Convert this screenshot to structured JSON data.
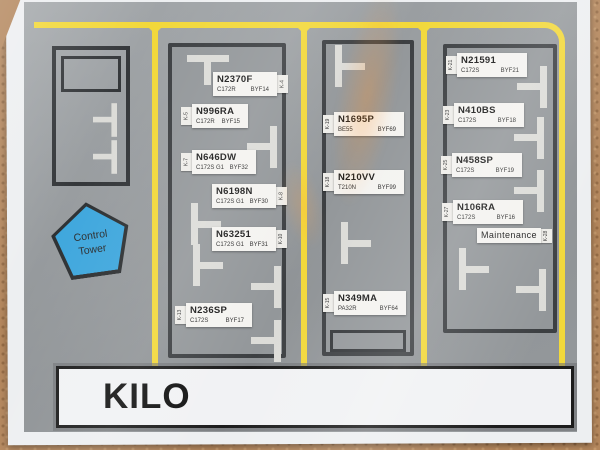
{
  "banner": {
    "title": "KILO"
  },
  "control_tower": {
    "label": "Control Tower"
  },
  "colors": {
    "taxiway_yellow": "#f2d83a",
    "tower_blue": "#3fa7dd",
    "label_white": "#f4f3f0",
    "cork_tan": "#b3865c"
  },
  "spots": [
    {
      "id": "K-4",
      "reg": "N2370F",
      "model": "C172R",
      "code": "BYF14",
      "x": 213,
      "y": 72,
      "w": 64,
      "tab": "right"
    },
    {
      "id": "K-5",
      "reg": "N996RA",
      "model": "C172R",
      "code": "BYF15",
      "x": 192,
      "y": 104,
      "w": 56,
      "tab": "left"
    },
    {
      "id": "K-7",
      "reg": "N646DW",
      "model": "C172S G1",
      "code": "BYF32",
      "x": 192,
      "y": 150,
      "w": 64,
      "tab": "left"
    },
    {
      "id": "K-8",
      "reg": "N6198N",
      "model": "C172S G1",
      "code": "BYF30",
      "x": 212,
      "y": 184,
      "w": 64,
      "tab": "right"
    },
    {
      "id": "K-10",
      "reg": "N63251",
      "model": "C172S G1",
      "code": "BYF31",
      "x": 212,
      "y": 227,
      "w": 64,
      "tab": "right"
    },
    {
      "id": "K-13",
      "reg": "N236SP",
      "model": "C172S",
      "code": "BYF17",
      "x": 186,
      "y": 303,
      "w": 66,
      "tab": "left"
    },
    {
      "id": "K-19",
      "reg": "N1695P",
      "model": "BE55",
      "code": "BYF69",
      "x": 334,
      "y": 112,
      "w": 70,
      "tab": "left"
    },
    {
      "id": "K-18",
      "reg": "N210VV",
      "model": "T210N",
      "code": "BYF99",
      "x": 334,
      "y": 170,
      "w": 70,
      "tab": "left"
    },
    {
      "id": "K-15",
      "reg": "N349MA",
      "model": "PA32R",
      "code": "BYF64",
      "x": 334,
      "y": 291,
      "w": 72,
      "tab": "left"
    },
    {
      "id": "K-21",
      "reg": "N21591",
      "model": "C172S",
      "code": "BYF21",
      "x": 457,
      "y": 53,
      "w": 70,
      "tab": "left"
    },
    {
      "id": "K-23",
      "reg": "N410BS",
      "model": "C172S",
      "code": "BYF18",
      "x": 454,
      "y": 103,
      "w": 70,
      "tab": "left"
    },
    {
      "id": "K-25",
      "reg": "N458SP",
      "model": "C172S",
      "code": "BYF19",
      "x": 452,
      "y": 153,
      "w": 70,
      "tab": "left"
    },
    {
      "id": "K-27",
      "reg": "N106RA",
      "model": "C172S",
      "code": "BYF16",
      "x": 453,
      "y": 200,
      "w": 70,
      "tab": "left"
    },
    {
      "id": "K-28",
      "reg": "Maintenance",
      "model": "",
      "code": "",
      "x": 477,
      "y": 228,
      "w": 64,
      "tab": "right",
      "single": true
    }
  ],
  "tie_downs": [
    {
      "x": 208,
      "y": 70,
      "r": 0
    },
    {
      "x": 262,
      "y": 147,
      "r": 90
    },
    {
      "x": 206,
      "y": 224,
      "r": -90
    },
    {
      "x": 208,
      "y": 265,
      "r": -90
    },
    {
      "x": 266,
      "y": 287,
      "r": 90
    },
    {
      "x": 266,
      "y": 341,
      "r": 90
    },
    {
      "x": 350,
      "y": 66,
      "r": -90
    },
    {
      "x": 356,
      "y": 243,
      "r": -90
    },
    {
      "x": 532,
      "y": 87,
      "r": 90
    },
    {
      "x": 529,
      "y": 138,
      "r": 90
    },
    {
      "x": 529,
      "y": 191,
      "r": 90
    },
    {
      "x": 474,
      "y": 269,
      "r": -90
    },
    {
      "x": 531,
      "y": 290,
      "r": 90
    },
    {
      "x": 105,
      "y": 120,
      "r": 90,
      "s": 0.8
    },
    {
      "x": 105,
      "y": 157,
      "r": 90,
      "s": 0.8
    }
  ]
}
